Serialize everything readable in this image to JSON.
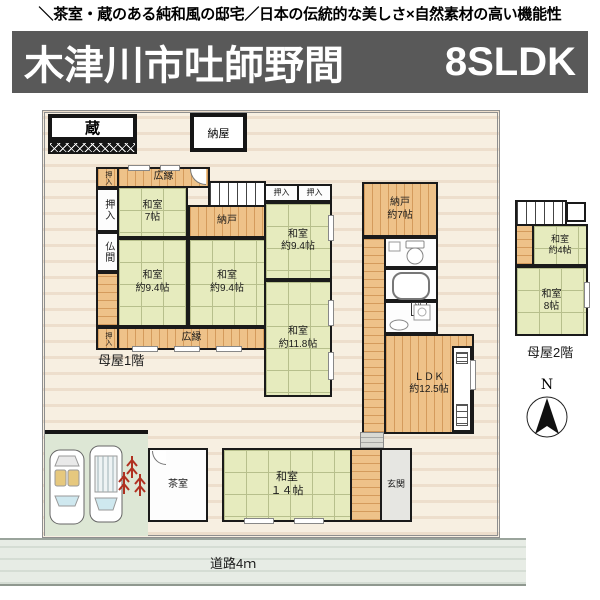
{
  "header": {
    "tagline": "＼茶室・蔵のある純和風の邸宅／日本の伝統的な美しさ×自然素材の高い機能性"
  },
  "title": {
    "location": "木津川市吐師野間",
    "plan": "8SLDK"
  },
  "colors": {
    "title_bar_bg": "#595959",
    "tatami": "#e6ebbe",
    "wood": "#eec289",
    "plot": "#f7efe1",
    "road": "#e7ece5",
    "parking": "#dde7d5"
  },
  "fp": {
    "kura": "蔵",
    "naya": "納屋",
    "hiroen": "広縁",
    "oshiire": "押入",
    "butsuma": "仏間",
    "washitsu7": "和室\n7帖",
    "nando": "納戸",
    "washitsu94": "和室\n約9.4帖",
    "washitsu118": "和室\n約11.8帖",
    "nando7": "納戸\n約7帖",
    "wash": "洗",
    "ldk": "ＬＤＫ\n約12.5帖",
    "moya1": "母屋1階",
    "moya2": "母屋2階",
    "washitsu4": "和室\n約4帖",
    "washitsu8": "和室\n8帖",
    "chashitsu": "茶室",
    "washitsu14": "和室\n１４帖",
    "genkan": "玄関",
    "road": "道路4ｍ",
    "north": "N"
  }
}
